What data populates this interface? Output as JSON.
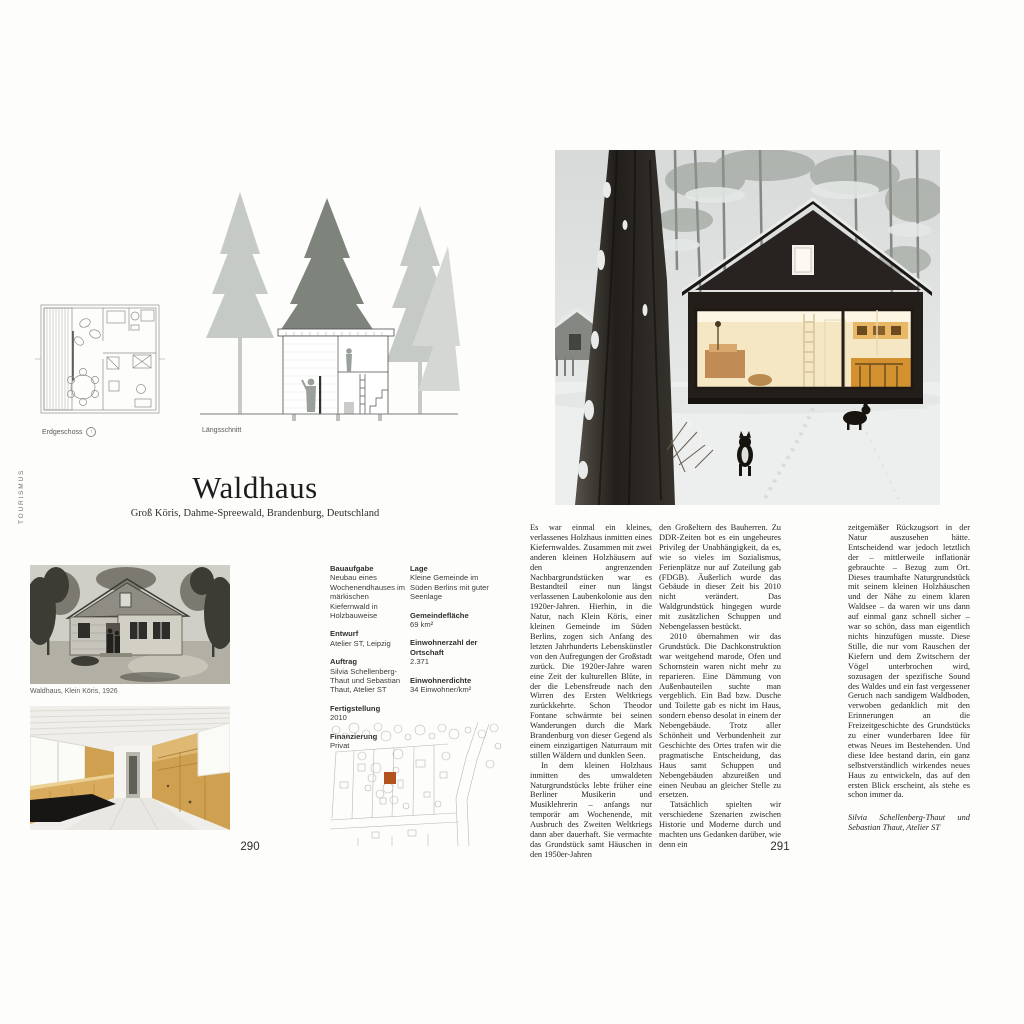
{
  "sidebar": {
    "label": "TOURISMUS"
  },
  "left_page": {
    "plan_label": "Erdgeschoss",
    "section_label": "Längsschnitt",
    "title": "Waldhaus",
    "subtitle": "Groß Köris, Dahme-Spreewald, Brandenburg, Deutschland",
    "photo_caption": "Waldhaus, Klein Köris, 1926",
    "page_number": "290",
    "facts1": [
      {
        "label": "Bauaufgabe",
        "value": "Neubau eines Wochenendhauses im märkischen Kiefernwald in Holzbauweise"
      },
      {
        "label": "Entwurf",
        "value": "Atelier ST, Leipzig"
      },
      {
        "label": "Auftrag",
        "value": "Silvia Schellenberg-Thaut und Sebastian Thaut, Atelier ST"
      },
      {
        "label": "Fertigstellung",
        "value": "2010"
      },
      {
        "label": "Finanzierung",
        "value": "Privat"
      }
    ],
    "facts2": [
      {
        "label": "Lage",
        "value": "Kleine Gemeinde im Süden Berlins mit guter Seenlage"
      },
      {
        "label": "Gemeindefläche",
        "value": "69 km²"
      },
      {
        "label": "Einwohnerzahl der Ortschaft",
        "value": "2.371"
      },
      {
        "label": "Einwohnerdichte",
        "value": "34 Einwohner/km²"
      }
    ],
    "site_plan_accent_color": "#b2531e"
  },
  "right_page": {
    "page_number": "291",
    "col1": [
      "Es war einmal ein kleines, verlassenes Holzhaus inmitten eines Kiefernwaldes. Zusammen mit zwei anderen kleinen Holzhäusern auf den angrenzenden Nachbargrundstücken war es Bestandteil einer nun längst verlassenen Laubenkolonie aus den 1920er-Jahren. Hierhin, in die Natur, nach Klein Köris, einer kleinen Gemeinde im Süden Berlins, zogen sich Anfang des letzten Jahrhunderts Lebenskünstler von den Aufregungen der Großstadt zurück. Die 1920er-Jahre waren eine Zeit der kulturellen Blüte, in der die Lebensfreude nach den Wirren des Ersten Weltkriegs zurückkehrte. Schon Theodor Fontane schwärmte bei seinen Wanderungen durch die Mark Brandenburg von dieser Gegend als einem einzigartigen Naturraum mit stillen Wäldern und dunklen Seen.",
      "In dem kleinen Holzhaus inmitten des umwaldeten Naturgrundstücks lebte früher eine Berliner Musikerin und Musiklehrerin – anfangs nur temporär am Wochenende, mit Ausbruch des Zweiten Weltkriegs dann aber dauerhaft. Sie vermachte das Grundstück samt Häuschen in den 1950er-Jahren"
    ],
    "col2": [
      "den Großeltern des Bauherren. Zu DDR-Zeiten bot es ein ungeheures Privileg der Unabhängigkeit, da es, wie so vieles im Sozialismus, Ferienplätze nur auf Zuteilung gab (FDGB). Äußerlich wurde das Gebäude in dieser Zeit bis 2010 nicht verändert. Das Waldgrundstück hingegen wurde mit zusätzlichen Schuppen und Nebengelassen bestückt.",
      "2010 übernahmen wir das Grundstück. Die Dachkonstruktion war weitgehend marode, Ofen und Schornstein waren nicht mehr zu reparieren. Eine Dämmung von Außenbauteilen suchte man vergeblich. Ein Bad bzw. Dusche und Toilette gab es nicht im Haus, sondern ebenso desolat in einem der Nebengebäude. Trotz aller Schönheit und Verbundenheit zur Geschichte des Ortes trafen wir die pragmatische Entscheidung, das Haus samt Schuppen und Nebengebäuden abzureißen und einen Neubau an gleicher Stelle zu ersetzen.",
      "Tatsächlich spielten wir verschiedene Szenarien zwischen Historie und Moderne durch und machten uns Gedanken darüber, wie denn ein"
    ],
    "col3": [
      "zeitgemäßer Rückzugsort in der Natur auszusehen hätte. Entscheidend war jedoch letztlich der – mittlerweile inflationär gebrauchte – Bezug zum Ort. Dieses traumhafte Naturgrundstück mit seinem kleinen Holzhäuschen und der Nähe zu einem klaren Waldsee – da waren wir uns dann auf einmal ganz schnell sicher – war so schön, dass man eigentlich nichts hinzufügen musste. Diese Stille, die nur vom Rauschen der Kiefern und dem Zwitschern der Vögel unterbrochen wird, sozusagen der spezifische Sound des Waldes und ein fast vergessener Geruch nach sandigem Waldboden, verwoben gedanklich mit den Erinnerungen an die Freizeitgeschichte des Grundstücks zu einer wunderbaren Idee für etwas Neues im Bestehenden. Und diese Idee bestand darin, ein ganz selbstverständlich wirkendes neues Haus zu entwickeln, das auf den ersten Blick erscheint, als stehe es schon immer da."
    ],
    "credit": "Silvia Schellenberg-Thaut und Sebastian Thaut, Atelier ST"
  }
}
